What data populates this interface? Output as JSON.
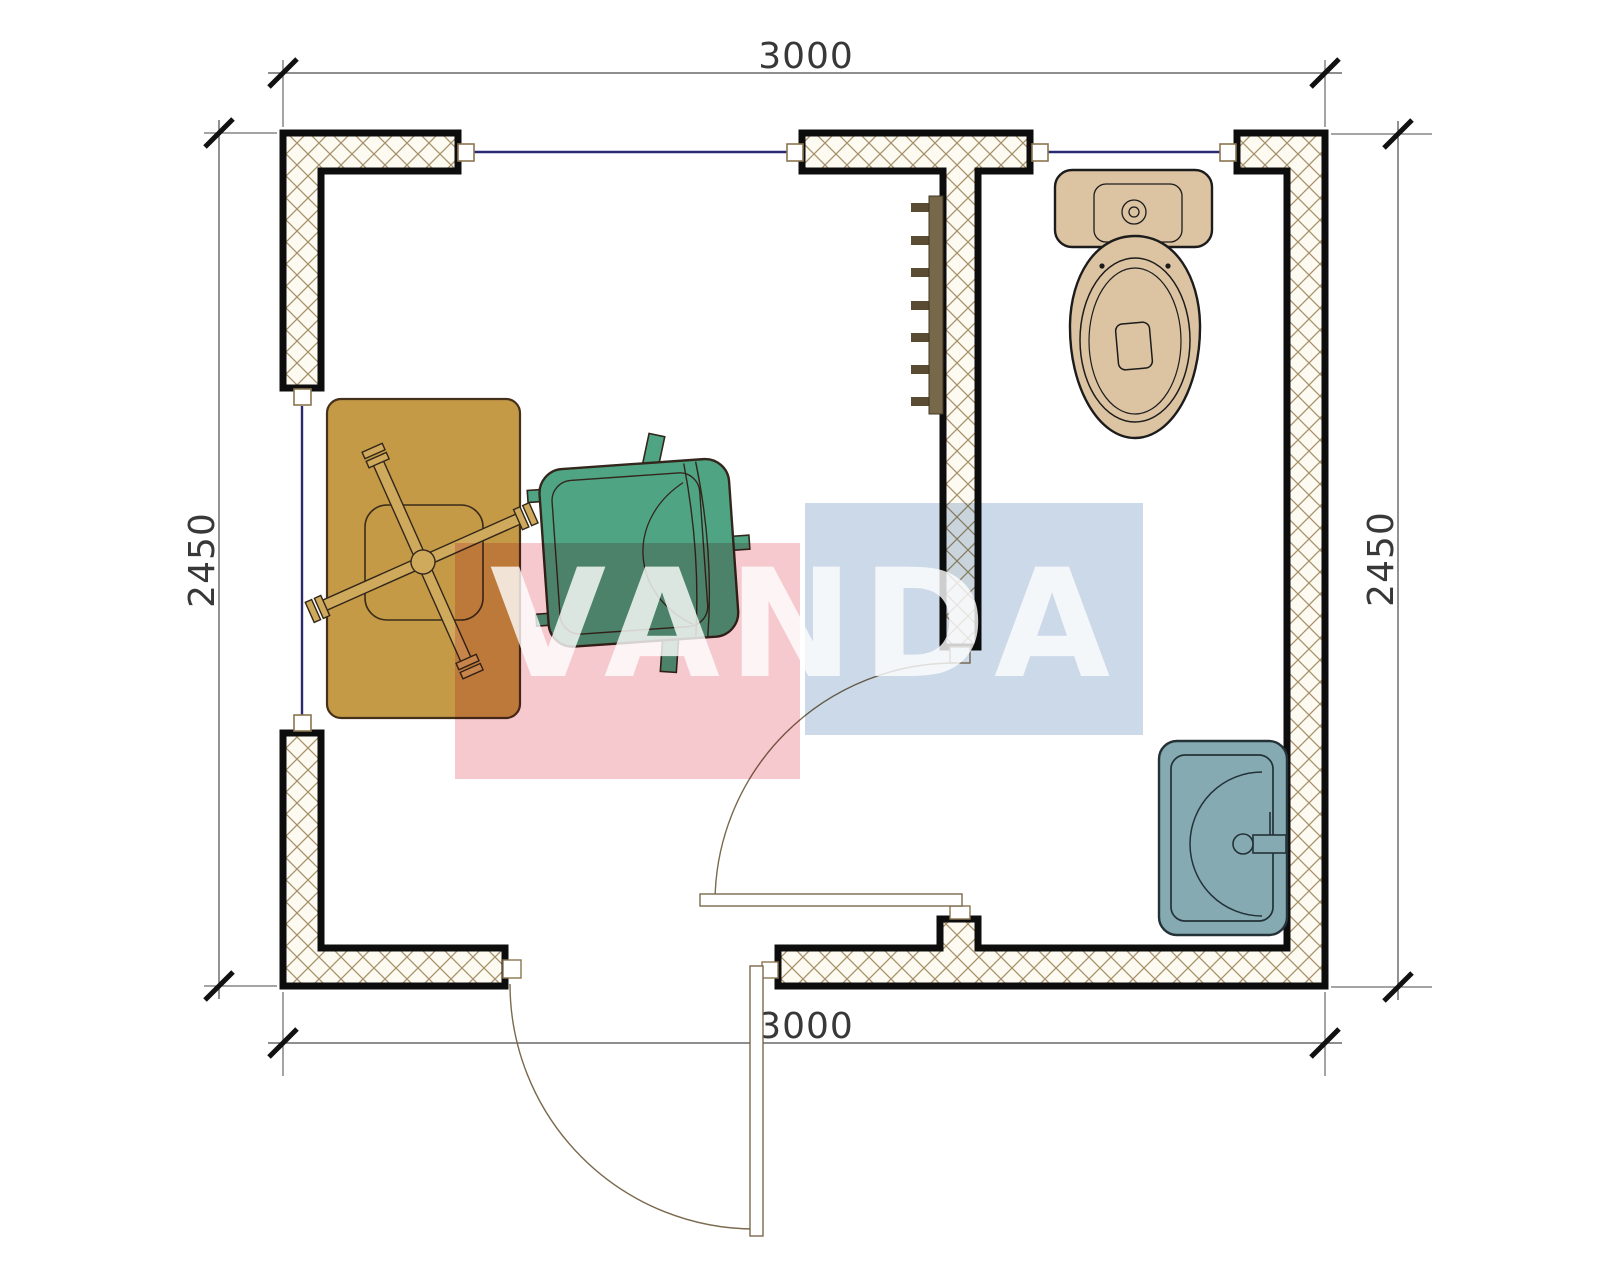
{
  "plan": {
    "type": "floor-plan",
    "rooms_visible": 2,
    "objects": [
      "desk",
      "desk-chair-base",
      "armchair",
      "toilet",
      "sink",
      "radiator",
      "entry-door",
      "interior-door",
      "window-top-left",
      "window-top-right",
      "window-left"
    ]
  },
  "dimensions": {
    "top": {
      "label": "3000"
    },
    "bottom": {
      "label": "3000"
    },
    "left": {
      "label": "2450"
    },
    "right": {
      "label": "2450"
    }
  },
  "watermark": {
    "text": "VANDA"
  },
  "colors": {
    "wall_outline": "#0d0d0d",
    "wall_fill_pattern_line": "#a6916a",
    "window_glass": "#2a2a72",
    "frame": "#8a7450",
    "door": "#7a6a4e",
    "dim_text": "#383838",
    "desk": "#c49a47",
    "desk_outline": "#453019",
    "chair_green": "#4fa583",
    "chair_outline": "#33261c",
    "toilet": "#dcc3a2",
    "toilet_outline": "#1c1c1c",
    "sink": "#85aab2",
    "sink_outline": "#243238",
    "radiator_bar": "#77684a",
    "radiator_fin": "#5a4c33",
    "watermark_red": "#f6c9cf",
    "watermark_blue": "#ccd9e8",
    "watermark_text": "#ffffff"
  }
}
